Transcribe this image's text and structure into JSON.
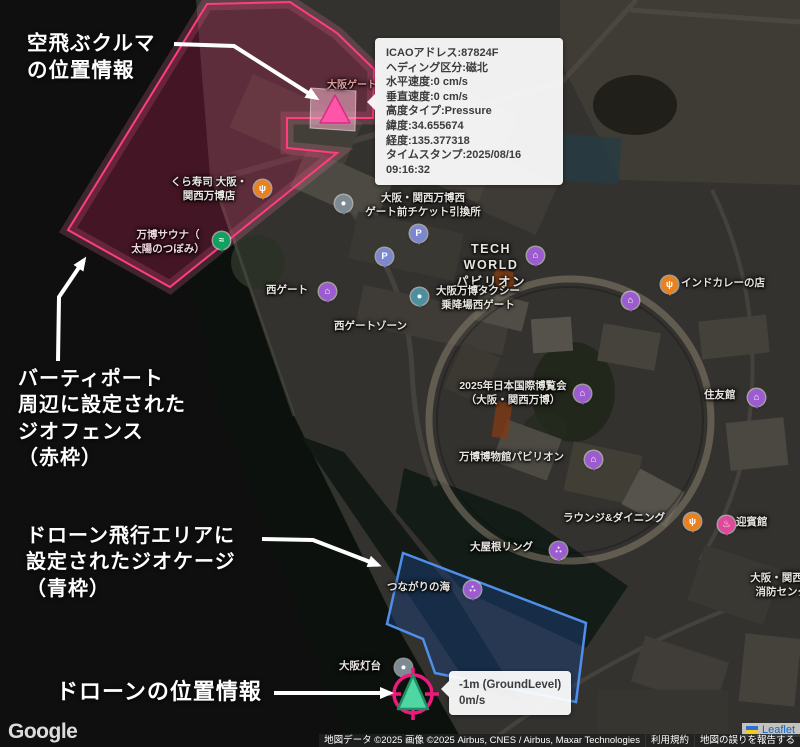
{
  "annotations": {
    "flying_car": "空飛ぶクルマ\nの位置情報",
    "geofence": "バーティポート\n周辺に設定された\nジオフェンス\n（赤枠）",
    "geocage": "ドローン飛行エリアに\n設定されたジオケージ\n（青枠）",
    "drone": "ドローンの位置情報"
  },
  "aircraft_tooltip": {
    "lines": [
      "ICAOアドレス:87824F",
      "ヘディング区分:磁北",
      "水平速度:0 cm/s",
      "垂直速度:0 cm/s",
      "高度タイプ:Pressure",
      "緯度:34.655674",
      "経度:135.377318",
      "タイムスタンプ:2025/08/16 09:16:32"
    ]
  },
  "drone_tooltip": {
    "altitude": "-1m (GroundLevel)",
    "speed": "0m/s"
  },
  "map_labels": [
    {
      "text": "くら寿司 大阪・\n関西万博店"
    },
    {
      "text": "万博サウナ（\n太陽のつぼみ）"
    },
    {
      "text": "大阪・関西万博西\nゲート前チケット引換所"
    },
    {
      "text": "TECH WORLD\nパビリオン"
    },
    {
      "text": "大阪万博タクシー\n乗降場西ゲート"
    },
    {
      "text": "西ゲート"
    },
    {
      "text": "西ゲートゾーン"
    },
    {
      "text": "大阪ゲート"
    },
    {
      "text": "2025年日本国際博覧会\n（大阪・関西万博）"
    },
    {
      "text": "住友館"
    },
    {
      "text": "インドカレーの店"
    },
    {
      "text": "万博博物館パビリオン"
    },
    {
      "text": "ラウンジ&ダイニング"
    },
    {
      "text": "迎賓館"
    },
    {
      "text": "大屋根リング"
    },
    {
      "text": "つながりの海"
    },
    {
      "text": "大阪灯台"
    },
    {
      "text": "大阪・関西万博\n消防センター"
    }
  ],
  "pins": [
    {
      "name": "restaurant",
      "glyph": "ψ",
      "color": "#e8821e"
    },
    {
      "name": "spa",
      "glyph": "≈",
      "color": "#12a05f"
    },
    {
      "name": "ticket",
      "glyph": "●",
      "color": "#7d8a94"
    },
    {
      "name": "parking",
      "glyph": "P",
      "color": "#7b87cf"
    },
    {
      "name": "parking",
      "glyph": "P",
      "color": "#7b87cf"
    },
    {
      "name": "pavilion",
      "glyph": "⌂",
      "color": "#9c5bd1"
    },
    {
      "name": "taxi",
      "glyph": "●",
      "color": "#4c8f9e"
    },
    {
      "name": "gate",
      "glyph": "⌂",
      "color": "#9c5bd1"
    },
    {
      "name": "expo",
      "glyph": "⌂",
      "color": "#9c5bd1"
    },
    {
      "name": "pavilion",
      "glyph": "⌂",
      "color": "#9c5bd1"
    },
    {
      "name": "restaurant",
      "glyph": "ψ",
      "color": "#e8821e"
    },
    {
      "name": "pavilion",
      "glyph": "⌂",
      "color": "#9c5bd1"
    },
    {
      "name": "museum",
      "glyph": "⌂",
      "color": "#9c5bd1"
    },
    {
      "name": "restaurant",
      "glyph": "ψ",
      "color": "#e8821e"
    },
    {
      "name": "guesthouse",
      "glyph": "♨",
      "color": "#e0489b"
    },
    {
      "name": "attraction",
      "glyph": "∴",
      "color": "#9c5bd1"
    },
    {
      "name": "attraction",
      "glyph": "∴",
      "color": "#9c5bd1"
    },
    {
      "name": "lighthouse",
      "glyph": "●",
      "color": "#7d8a94"
    }
  ],
  "overlays": {
    "geofence_fill": "#c02458",
    "geofence_stroke": "#ff3d7f",
    "geocage_fill": "#1c3e78",
    "geocage_stroke": "#4f8fe8",
    "vertiport_fill": "#f7b6cf"
  },
  "markers": {
    "flying_car_fill": "#ff55a8",
    "flying_car_stroke": "#d62e86",
    "drone_ring": "#ef187d",
    "drone_fill": "#4fd6a2",
    "drone_stroke": "#1f8f63"
  },
  "attribution": {
    "google": "Google",
    "map_data": "地図データ ©2025 画像 ©2025 Airbus, CNES / Airbus, Maxar Technologies",
    "terms": "利用規約",
    "report": "地図の誤りを報告する",
    "leaflet": "Leaflet"
  }
}
